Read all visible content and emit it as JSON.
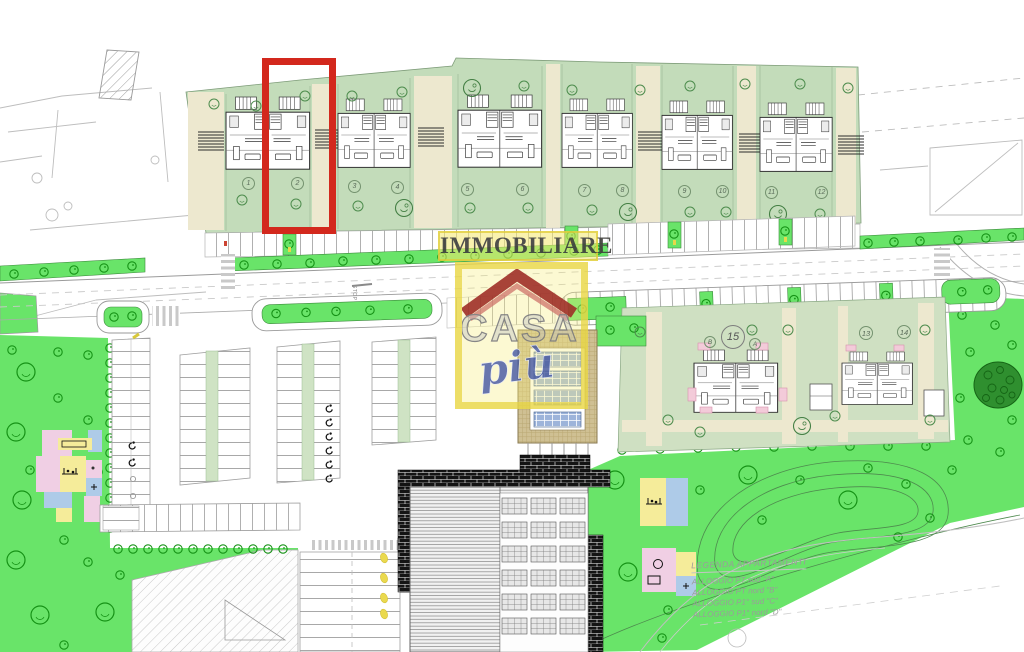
{
  "watermark": {
    "brand_top": "IMMOBILIARE",
    "brand_main": "CASA",
    "brand_sub": "più"
  },
  "plan": {
    "top_row_units": [
      "1",
      "2",
      "3",
      "4",
      "5",
      "6",
      "7",
      "8",
      "9",
      "10",
      "11",
      "12"
    ],
    "south_units": {
      "unit_15": "15",
      "unit_15_left": "B",
      "unit_15_right": "A",
      "unit_13": "13",
      "unit_14": "14"
    },
    "road_marking": "STOP",
    "highlighted_unit": "2"
  },
  "legend": {
    "title": "LEGENDA APPARTAMENTI",
    "items": [
      "ALLOGGIO PT sud \"A\"",
      "ALLOGGIO PT nord \"B\"",
      "ALLOGGIO P1° sud \"C\"",
      "ALLOGGIO P1° nord \"D\""
    ]
  },
  "colors": {
    "lawn_green": "#69e469",
    "parcel_green": "#c3dcba",
    "path_cream": "#ede8cf",
    "highlight_red": "#d3281d",
    "watermark_yellow": "#f2e678",
    "roof_red": "#a83226",
    "casa_gray": "#8e8e8e",
    "piu_blue": "#3f54a0"
  }
}
